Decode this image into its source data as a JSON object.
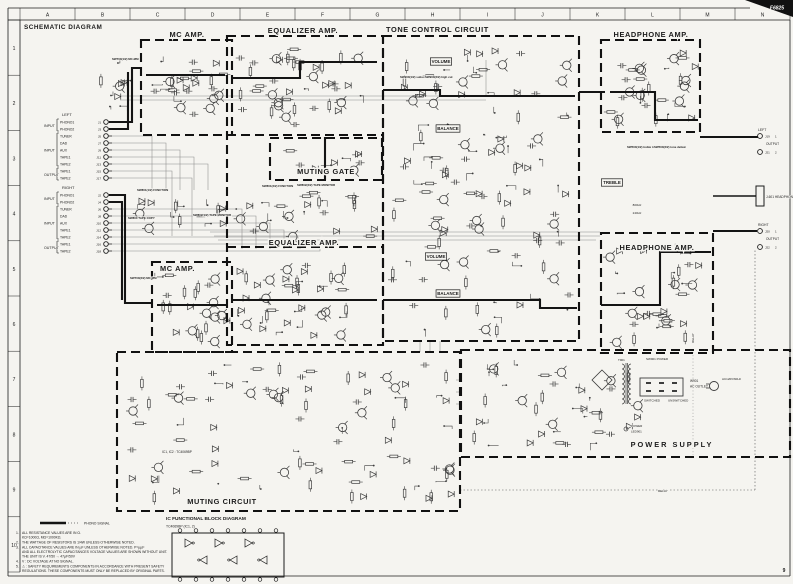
{
  "page": {
    "title": "SCHEMATIC DIAGRAM",
    "model": "F6825",
    "page_number": "9"
  },
  "ruler": {
    "columns": [
      "A",
      "B",
      "C",
      "D",
      "E",
      "F",
      "G",
      "H",
      "I",
      "J",
      "K",
      "L",
      "M",
      "N"
    ],
    "rows": [
      "1",
      "2",
      "3",
      "4",
      "5",
      "6",
      "7",
      "8",
      "9",
      "10"
    ]
  },
  "blocks": [
    {
      "id": "mc-amp-1",
      "title": "MC AMP."
    },
    {
      "id": "equalizer-amp-1",
      "title": "EQUALIZER AMP."
    },
    {
      "id": "muting-gate",
      "title": "MUTING GATE"
    },
    {
      "id": "tone-control",
      "title": "TONE CONTROL CIRCUIT"
    },
    {
      "id": "headphone-amp-1",
      "title": "HEADPHONE AMP."
    },
    {
      "id": "equalizer-amp-2",
      "title": "EQUALIZER AMP."
    },
    {
      "id": "mc-amp-2",
      "title": "MC AMP."
    },
    {
      "id": "headphone-amp-2",
      "title": "HEADPHONE AMP."
    },
    {
      "id": "muting-circuit",
      "title": "MUTING CIRCUIT"
    },
    {
      "id": "power-supply",
      "title": "POWER SUPPLY"
    }
  ],
  "jack_panel": {
    "left": {
      "channel": "LEFT",
      "groups": [
        {
          "label": "INPUT",
          "items": [
            {
              "name": "PHONO1",
              "jack": "J1"
            },
            {
              "name": "PHONO2",
              "jack": "J3"
            }
          ]
        },
        {
          "label": "INPUT",
          "items": [
            {
              "name": "TUNER",
              "jack": "J5"
            },
            {
              "name": "DAD",
              "jack": "J7"
            },
            {
              "name": "AUX",
              "jack": "J9"
            },
            {
              "name": "TAPE1",
              "jack": "J11"
            },
            {
              "name": "TAPE2",
              "jack": "J13"
            }
          ]
        },
        {
          "label": "OUTPUT",
          "items": [
            {
              "name": "TAPE1",
              "jack": "J15"
            },
            {
              "name": "TAPE2",
              "jack": "J17"
            }
          ]
        }
      ]
    },
    "right": {
      "channel": "RIGHT",
      "groups": [
        {
          "label": "INPUT",
          "items": [
            {
              "name": "PHONO1",
              "jack": "J2"
            },
            {
              "name": "PHONO2",
              "jack": "J4"
            }
          ]
        },
        {
          "label": "INPUT",
          "items": [
            {
              "name": "TUNER",
              "jack": "J6"
            },
            {
              "name": "DAD",
              "jack": "J8"
            },
            {
              "name": "AUX",
              "jack": "J10"
            },
            {
              "name": "TAPE1",
              "jack": "J12"
            },
            {
              "name": "TAPE2",
              "jack": "J14"
            }
          ]
        },
        {
          "label": "OUTPUT",
          "items": [
            {
              "name": "TAPE1",
              "jack": "J16"
            },
            {
              "name": "TAPE2",
              "jack": "J18"
            }
          ]
        }
      ]
    }
  },
  "output_panel": {
    "left": {
      "channel": "LEFT",
      "label": "OUTPUT",
      "jacks": [
        {
          "id": "J19",
          "pin": "1"
        },
        {
          "id": "J21",
          "pin": "2"
        }
      ]
    },
    "headphones": {
      "label": "J-601 HEADPHONES"
    },
    "right": {
      "channel": "RIGHT",
      "label": "OUTPUT",
      "jacks": [
        {
          "id": "J20",
          "pin": "1"
        },
        {
          "id": "J22",
          "pin": "2"
        }
      ]
    }
  },
  "controls": {
    "volume": "VOLUME",
    "balance": "BALANCE",
    "treble": "TREBLE",
    "freq1": "800Hz",
    "freq2": "240Hz"
  },
  "switch_labels": [
    {
      "text": "SW700(1/2) MC·MM"
    },
    {
      "text": "SW700(2/2) MC·MM"
    },
    {
      "text": "SW801(1/2) FUNCTION"
    },
    {
      "text": "SW801(2/2) FUNCTION"
    },
    {
      "text": "SW800 TAPE COPY"
    },
    {
      "text": "SW802(1/2) TAPE MONITOR"
    },
    {
      "text": "SW802(2/2) TAPE MONITOR"
    },
    {
      "text": "SW900(1/2) subsonic"
    },
    {
      "text": "SW900(2/2) high cut"
    },
    {
      "text": "SW500(1/2) treble turnover"
    },
    {
      "text": "SW500(2/2) tone defeat"
    }
  ],
  "power_supply": {
    "transformer": "T901",
    "switch": "SW901 POWER",
    "outlet_ref": "W901",
    "ac_outlet": "AC OUTLET",
    "switched": "SWITCHED",
    "unswitched": "UNSWITCHED",
    "ac_plug": "AC120V/60Hz",
    "power": "POWER",
    "led": "LED901",
    "relay": "RELAY"
  },
  "muting": {
    "ic_note": "IC1, IC2 : TC4069BP"
  },
  "ic_diagram": {
    "title": "IC FUNCTIONAL BLOCK DIAGRAM",
    "subtitle": "TC4069BP (IC1, 2)"
  },
  "legend": {
    "phono_signal": "PHONO SIGNAL"
  },
  "notes": [
    {
      "num": "1.",
      "lines": [
        "ALL RESISTANCE VALUES ARE IN Ω.",
        "KΩ=1000Ω, MΩ=1000KΩ."
      ]
    },
    {
      "num": "2.",
      "lines": [
        "THE WATTAGE OF RESISTORS IS 1/4W UNLESS OTHERWISE NOTED."
      ]
    },
    {
      "num": "3.",
      "lines": [
        "ALL CAPACITANCE VALUES ARE IN µF UNLESS OTHERWISE NOTED. P=µµF",
        "AND ALL ELECTROLYTIC CAPACITANCES VOLTAGE VALUES ARE SHOWN WITHOUT UNIT.",
        "THE UNIT IS V.    47/50 → 47µF/50V"
      ]
    },
    {
      "num": "4.",
      "lines": [
        "V : DC VOLTAGE AT NO SIGNAL."
      ]
    },
    {
      "num": "5.",
      "lines": [
        "⚠ : SAFETY REQUIREMENTS COMPONENTS IN ACCORDANCE WITH PRESENT SAFETY",
        "REGULATIONS. THESE COMPONENTS MUST ONLY BE REPLACED BY ORIGINAL PARTS."
      ]
    }
  ]
}
